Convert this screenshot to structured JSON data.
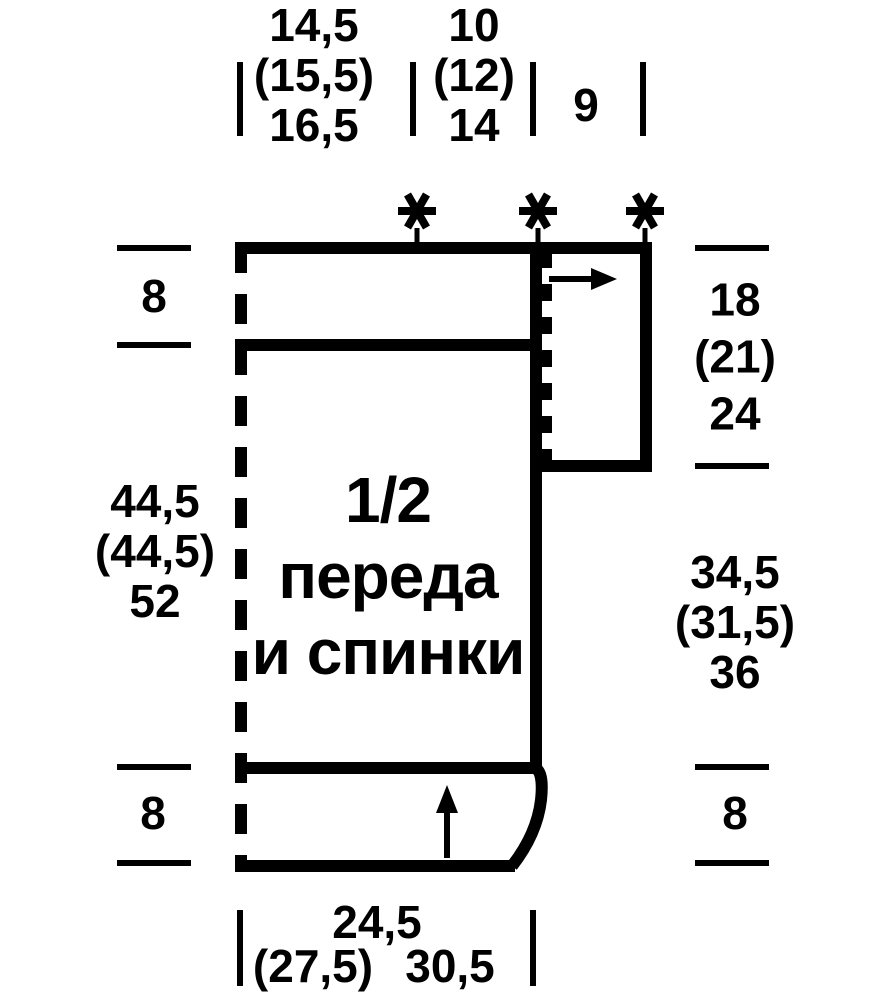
{
  "colors": {
    "ink": "#000000",
    "background": "#ffffff"
  },
  "title": {
    "lines": [
      "1/2",
      "переда",
      "и спинки"
    ]
  },
  "measurements": {
    "top": [
      {
        "lines": [
          "14,5",
          "(15,5)",
          "16,5"
        ]
      },
      {
        "lines": [
          "10",
          "(12)",
          "14"
        ]
      },
      {
        "lines": [
          "9"
        ]
      }
    ],
    "left": [
      {
        "lines": [
          "8"
        ]
      },
      {
        "lines": [
          "44,5",
          "(44,5)",
          "52"
        ]
      },
      {
        "lines": [
          "8"
        ]
      }
    ],
    "right": [
      {
        "lines": [
          "18",
          "(21)",
          "24"
        ]
      },
      {
        "lines": [
          "34,5",
          "(31,5)",
          "36"
        ]
      },
      {
        "lines": [
          "8"
        ]
      }
    ],
    "bottom": {
      "top_line": "24,5",
      "bottom_left": "(27,5)",
      "bottom_right": "30,5"
    }
  },
  "icons": {
    "asterisk": "✱",
    "arrow_right": "→",
    "arrow_up": "↑"
  }
}
